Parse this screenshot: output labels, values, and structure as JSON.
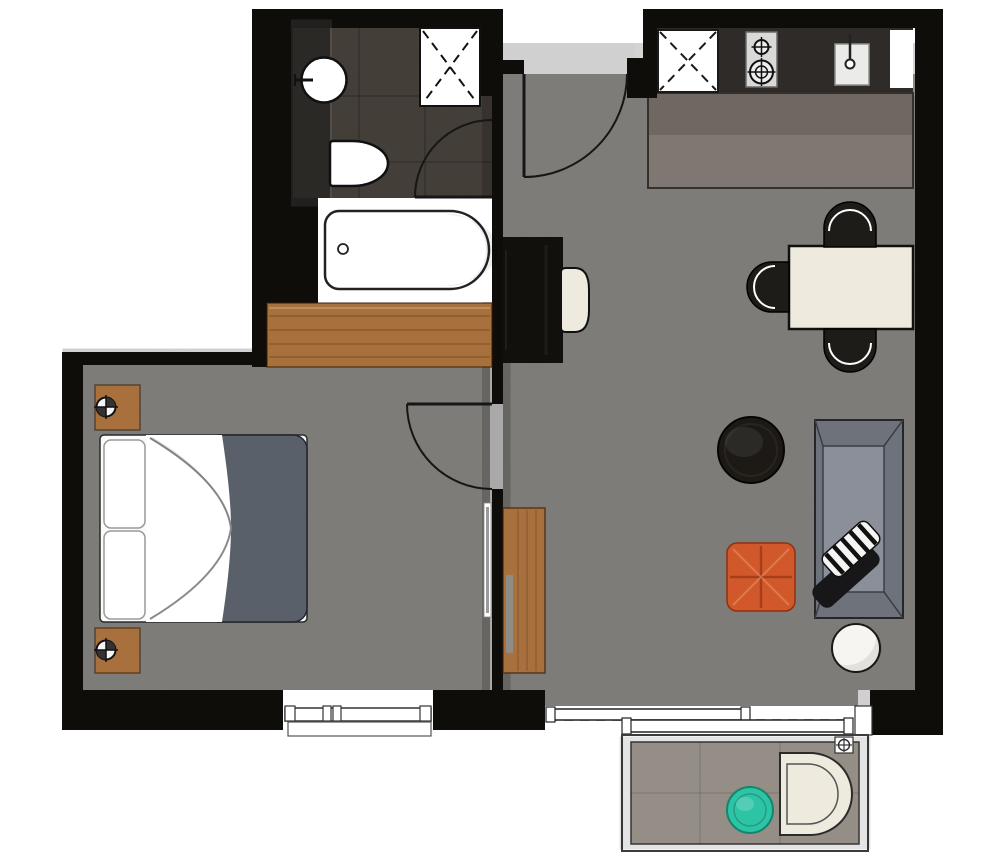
{
  "meta": {
    "kind": "apartment-floor-plan",
    "description": "Top-down 1-bedroom apartment floor plan with bathroom, kitchen, living-dining room, bedroom and balcony"
  },
  "colors": {
    "wall": "#0f0d0a",
    "floor": "#9b9994",
    "floor_bathroom": "#575049",
    "vanity_black": "#191613",
    "counter_black": "#16130f",
    "counter_upper": "#6e6762",
    "counter_lower": "#7f7872",
    "wood": "#a8703c",
    "cream": "#eeeadd",
    "chair_black": "#1e1c19",
    "duvet": "#596069",
    "sofa_frame": "#6d727b",
    "sofa_seat": "#8a8f99",
    "coffee_table_black": "#1d1a16",
    "desk_black": "#12100c",
    "orange": "#d1582b",
    "teal": "#2dc4a6",
    "balcony_floor": "#a79f97",
    "white": "#ffffff",
    "outline": "#141414"
  },
  "rooms": {
    "bathroom": {
      "label": "bathroom",
      "furniture": [
        "vanity-counter",
        "round-sink",
        "toilet",
        "shower",
        "bathtub"
      ]
    },
    "kitchen": {
      "label": "kitchen",
      "furniture": [
        "appliance-square",
        "hob-two-burners",
        "kitchen-sink",
        "worktop"
      ]
    },
    "living": {
      "label": "living-dining",
      "furniture": [
        "desk",
        "desk-chair",
        "tv-cabinet",
        "dining-table",
        "dining-chair-top",
        "dining-chair-left",
        "dining-chair-bottom",
        "coffee-table",
        "orange-ottoman",
        "sofa",
        "striped-cushion",
        "black-throw",
        "white-side-table"
      ]
    },
    "bedroom": {
      "label": "bedroom",
      "furniture": [
        "wardrobe",
        "nightstand-top",
        "nightstand-bottom",
        "lamp-top",
        "lamp-bottom",
        "double-bed",
        "wall-tv"
      ]
    },
    "balcony": {
      "label": "balcony",
      "furniture": [
        "teal-round-table",
        "lounge-chair",
        "ceiling-light"
      ]
    }
  },
  "doors": [
    "entry-door",
    "bathroom-door",
    "bedroom-door",
    "balcony-sliding-door"
  ],
  "windows": [
    "bedroom-window"
  ]
}
